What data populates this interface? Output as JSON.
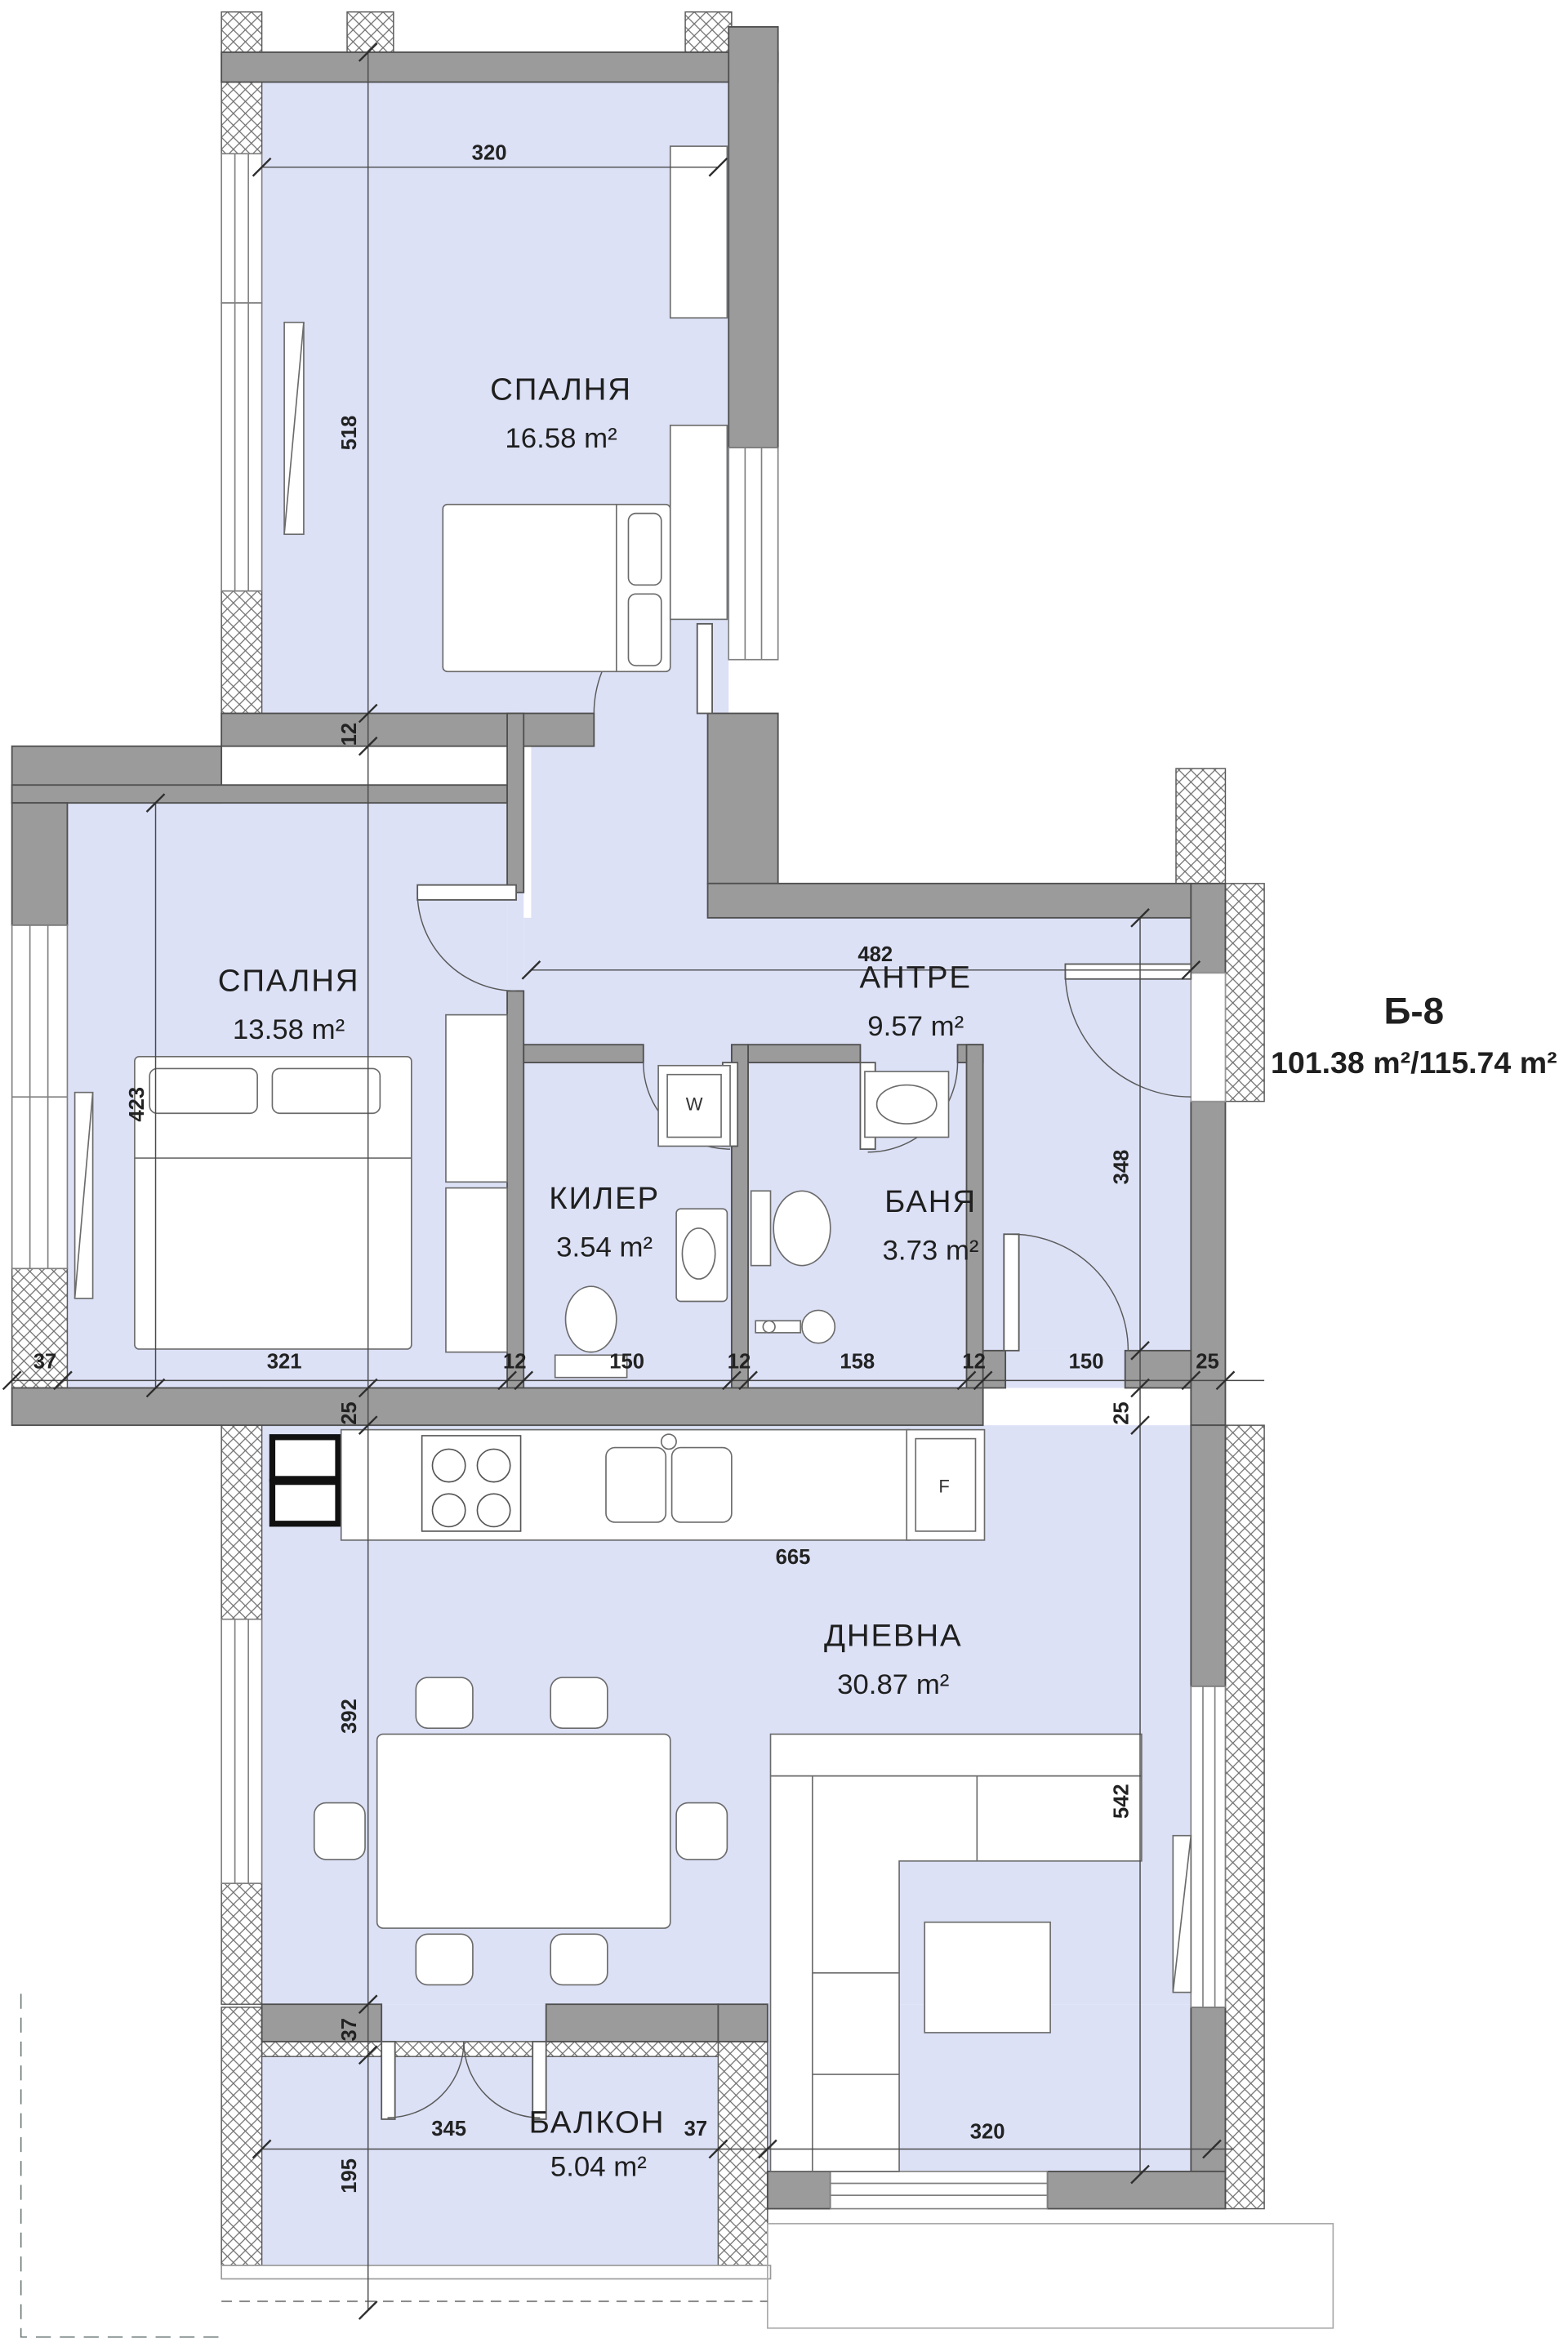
{
  "plan": {
    "unit_label": "Б-8",
    "unit_area": "101.38 m²/115.74 m²"
  },
  "rooms": [
    {
      "name": "СПАЛНЯ",
      "area": "16.58 m²"
    },
    {
      "name": "СПАЛНЯ",
      "area": "13.58 m²"
    },
    {
      "name": "АНТРЕ",
      "area": "9.57 m²"
    },
    {
      "name": "КИЛЕР",
      "area": "3.54 m²"
    },
    {
      "name": "БАНЯ",
      "area": "3.73 m²"
    },
    {
      "name": "ДНЕВНА",
      "area": "30.87 m²"
    },
    {
      "name": "БАЛКОН",
      "area": "5.04 m²"
    }
  ],
  "dimensions": {
    "top_width": "320",
    "bedroom1_height": "518",
    "wall_12": "12",
    "bedroom2_height": "423",
    "hall_width": "482",
    "entry_height": "348",
    "row": [
      "37",
      "321",
      "12",
      "150",
      "12",
      "158",
      "12",
      "150",
      "25"
    ],
    "wall_25_left": "25",
    "wall_25_right": "25",
    "kitchen_width": "665",
    "living_height_left": "392",
    "living_height_right": "542",
    "balcony_wall_37": "37",
    "balcony_width": "345",
    "balcony_wall_right": "37",
    "living_bottom_width": "320",
    "balcony_depth": "195"
  },
  "fixtures": {
    "washer_label": "W",
    "fridge_label": "F"
  }
}
